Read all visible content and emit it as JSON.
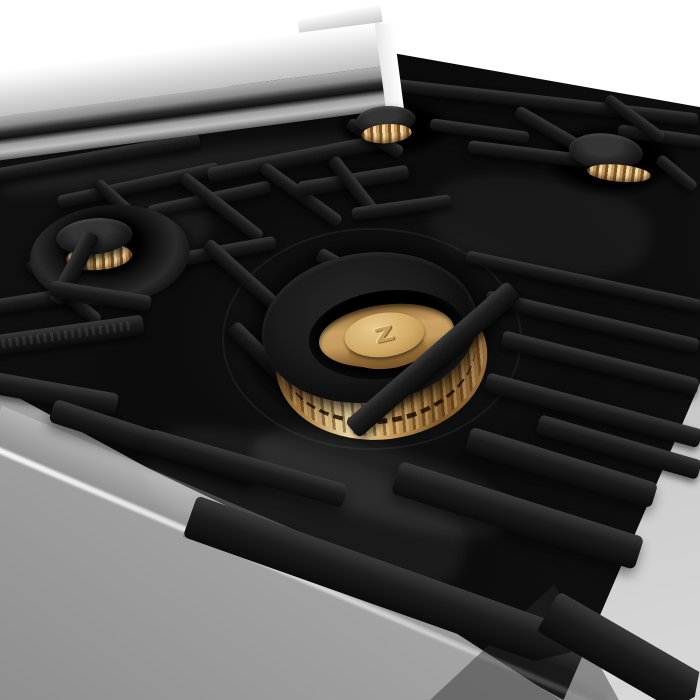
{
  "scene": {
    "description": "Angled close-up photo of a stainless steel gas range cooktop: black porcelain top, matte black cast-iron grates, polished brass burners with black caps, stainless backguard rail, brushed stainless front panel, white-to-gray studio backdrop",
    "colors": {
      "bg": "#ffffff",
      "stainless": "#d9d9d9",
      "panel": "#b2b2b2",
      "backdrop_hi": "#d8d8d8",
      "porcelain": "#0a0a0a",
      "grate": "#1c1c1c",
      "grate_hi": "#3a3a3a",
      "brass": "#c49a5d",
      "brass_hi": "#eed9a4"
    }
  },
  "logo": {
    "glyph": "Z"
  }
}
